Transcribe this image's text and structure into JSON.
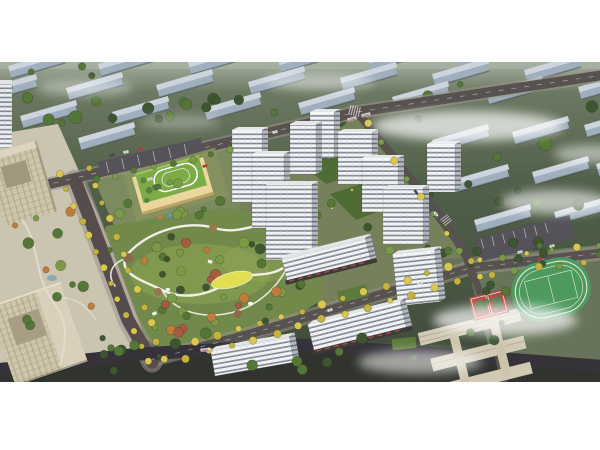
{
  "meta": {
    "subject": "aerial-masterplan-rendering",
    "framing": "white-letterbox"
  },
  "colors": {
    "page-bg": "#ffffff",
    "ground-top": "#75816a",
    "ground-mid": "#51604a",
    "ground-bottom": "#3e4a38",
    "haze": "#aab5a7",
    "fog": "#ffffff",
    "bg-building-top": "#ccd5de",
    "bg-building-face": "#9fafbd",
    "road": "#57524f",
    "road-dark": "#35323a",
    "sidewalk": "#9b938a",
    "boulevard": "#564c4e",
    "tower-face": "#f3f4f5",
    "tower-stripe": "#67707e",
    "tower-roof": "#e4e7ea",
    "office-face": "#cfc6ac",
    "office-line": "#9c9277",
    "park-base": "#71894a",
    "park-light": "#94aa57",
    "lawn-yellow": "#e0df52",
    "path-white": "#f1efe5",
    "tree-dark": "#3d5531",
    "tree-mid": "#547636",
    "tree-light": "#7a9a47",
    "tree-orange": "#c07c3c",
    "tree-red": "#a85a40",
    "tree-yellow": "#d9c750",
    "tree-yellow2": "#c4b23e",
    "kg-wall": "#ebd79e",
    "kg-roof": "#7cab48",
    "podium-green": "#5b7a3b",
    "courtyard-green": "#4e6c34",
    "field-green": "#4e9a5e",
    "court-red": "#b04a40",
    "track-white": "#e9e7de",
    "car-white": "#f2f2f2",
    "car-red": "#c24438",
    "car-dark": "#4a4f55",
    "parking-grey": "#55525a"
  },
  "scene": {
    "bg_blocks": [
      [
        8,
        4
      ],
      [
        98,
        2
      ],
      [
        188,
        0
      ],
      [
        278,
        -2
      ],
      [
        368,
        -4
      ],
      [
        458,
        -6
      ],
      [
        548,
        -8
      ],
      [
        -20,
        28
      ],
      [
        66,
        26
      ],
      [
        156,
        23
      ],
      [
        248,
        20
      ],
      [
        340,
        16
      ],
      [
        432,
        12
      ],
      [
        524,
        8
      ],
      [
        20,
        54
      ],
      [
        112,
        50
      ],
      [
        204,
        46
      ],
      [
        298,
        41
      ],
      [
        392,
        35
      ],
      [
        486,
        30
      ],
      [
        578,
        25
      ],
      [
        -10,
        80
      ],
      [
        78,
        76
      ],
      [
        432,
        78
      ],
      [
        512,
        70
      ],
      [
        584,
        63
      ],
      [
        452,
        118
      ],
      [
        532,
        110
      ],
      [
        596,
        102
      ],
      [
        474,
        158
      ],
      [
        554,
        150
      ]
    ],
    "buildings": [
      {
        "type": "tower",
        "x": 310,
        "base": 96,
        "w": 24,
        "h": 46
      },
      {
        "type": "tower",
        "x": 290,
        "base": 112,
        "w": 26,
        "h": 50
      },
      {
        "type": "tower",
        "x": 338,
        "base": 122,
        "w": 34,
        "h": 52
      },
      {
        "type": "tower",
        "x": 427,
        "base": 130,
        "w": 28,
        "h": 48
      },
      {
        "type": "tower",
        "x": 232,
        "base": 140,
        "w": 30,
        "h": 72
      },
      {
        "type": "tower",
        "x": 362,
        "base": 150,
        "w": 36,
        "h": 54
      },
      {
        "type": "tower",
        "x": 252,
        "base": 166,
        "w": 32,
        "h": 74
      },
      {
        "type": "tower",
        "x": 383,
        "base": 182,
        "w": 40,
        "h": 56
      },
      {
        "type": "tower",
        "x": 266,
        "base": 198,
        "w": 46,
        "h": 76
      },
      {
        "type": "slab",
        "x": 288,
        "base": 222,
        "w": 86,
        "h": 26,
        "rot": -14,
        "retail": true
      },
      {
        "type": "slab",
        "x": 398,
        "base": 244,
        "w": 42,
        "h": 52,
        "rot": -6
      },
      {
        "type": "slab",
        "x": 315,
        "base": 292,
        "w": 95,
        "h": 30,
        "rot": -14,
        "retail": true
      },
      {
        "type": "slab",
        "x": 215,
        "base": 314,
        "w": 80,
        "h": 26,
        "rot": -10
      }
    ],
    "avenues": [
      {
        "x1": 60,
        "y1": 112,
        "x2": 148,
        "y2": 300,
        "n": 13,
        "r": 3.2,
        "pal": [
          "tree-yellow",
          "tree-yellow2"
        ]
      },
      {
        "x1": 88,
        "y1": 106,
        "x2": 164,
        "y2": 296,
        "n": 12,
        "r": 3.0,
        "pal": [
          "tree-yellow2",
          "tree-yellow"
        ]
      },
      {
        "x1": 196,
        "y1": 280,
        "x2": 470,
        "y2": 200,
        "n": 14,
        "r": 3.4,
        "pal": [
          "tree-yellow",
          "tree-yellow2"
        ]
      },
      {
        "x1": 186,
        "y1": 296,
        "x2": 480,
        "y2": 214,
        "n": 14,
        "r": 3.2,
        "pal": [
          "tree-yellow2",
          "tree-yellow"
        ]
      },
      {
        "x1": 480,
        "y1": 198,
        "x2": 600,
        "y2": 183,
        "n": 6,
        "r": 3.0,
        "pal": [
          "tree-yellow",
          "tree-light"
        ]
      },
      {
        "x1": 492,
        "y1": 212,
        "x2": 606,
        "y2": 197,
        "n": 6,
        "r": 3.0,
        "pal": [
          "tree-yellow2",
          "tree-light"
        ]
      },
      {
        "x1": 96,
        "y1": 118,
        "x2": 230,
        "y2": 88,
        "n": 8,
        "r": 3.0,
        "pal": [
          "tree-mid",
          "tree-light"
        ]
      },
      {
        "x1": 368,
        "y1": 62,
        "x2": 460,
        "y2": 188,
        "n": 8,
        "r": 3.0,
        "pal": [
          "tree-yellow",
          "tree-light"
        ]
      }
    ],
    "scatter": [
      {
        "x": 0,
        "y": 0,
        "w": 92,
        "h": 66,
        "n": 10,
        "layer": "bg",
        "pal": [
          "tree-dark",
          "tree-mid"
        ],
        "rmin": 3,
        "rmax": 7
      },
      {
        "x": 96,
        "y": 30,
        "w": 210,
        "h": 34,
        "n": 12,
        "layer": "bg",
        "pal": [
          "tree-dark",
          "tree-mid"
        ],
        "rmin": 3,
        "rmax": 6
      },
      {
        "x": 360,
        "y": 6,
        "w": 238,
        "h": 150,
        "n": 16,
        "layer": "bg",
        "pal": [
          "tree-dark",
          "tree-mid"
        ],
        "rmin": 3,
        "rmax": 7
      },
      {
        "x": 300,
        "y": 58,
        "w": 60,
        "h": 30,
        "n": 5,
        "layer": "bg",
        "pal": [
          "tree-dark"
        ],
        "rmin": 3,
        "rmax": 5
      },
      {
        "x": 15,
        "y": 148,
        "w": 96,
        "h": 128,
        "n": 14,
        "layer": "mid",
        "pal": [
          "tree-mid",
          "tree-orange",
          "tree-light"
        ],
        "rmin": 2.6,
        "rmax": 5.5
      },
      {
        "x": 118,
        "y": 116,
        "w": 118,
        "h": 42,
        "n": 12,
        "layer": "mid",
        "pal": [
          "tree-mid",
          "tree-light"
        ],
        "rmin": 2.6,
        "rmax": 5
      },
      {
        "x": 250,
        "y": 84,
        "w": 150,
        "h": 112,
        "n": 14,
        "layer": "mid",
        "pal": [
          "tree-mid",
          "tree-light",
          "tree-dark"
        ],
        "rmin": 2.4,
        "rmax": 4.6
      },
      {
        "x": 420,
        "y": 176,
        "w": 180,
        "h": 26,
        "n": 12,
        "layer": "mid",
        "pal": [
          "tree-mid",
          "tree-dark"
        ],
        "rmin": 2.6,
        "rmax": 5
      },
      {
        "x": 468,
        "y": 210,
        "w": 40,
        "h": 100,
        "n": 8,
        "layer": "mid",
        "pal": [
          "tree-dark",
          "tree-mid"
        ],
        "rmin": 2.6,
        "rmax": 5
      },
      {
        "x": 60,
        "y": 276,
        "w": 400,
        "h": 36,
        "n": 16,
        "layer": "top",
        "pal": [
          "tree-dark",
          "tree-mid"
        ],
        "rmin": 2.6,
        "rmax": 5.5
      }
    ],
    "park": {
      "cx": 214,
      "cy": 222,
      "rx": 100,
      "ry": 54,
      "under": 30,
      "over": 12,
      "pal": [
        "tree-dark",
        "tree-mid",
        "tree-light",
        "tree-orange",
        "tree-red",
        "tree-light"
      ]
    },
    "fog": [
      [
        468,
        64,
        95,
        15,
        0.7
      ],
      [
        320,
        20,
        55,
        8,
        0.45
      ],
      [
        85,
        26,
        48,
        8,
        0.4
      ],
      [
        556,
        140,
        55,
        12,
        0.6
      ],
      [
        505,
        258,
        72,
        15,
        0.7
      ],
      [
        420,
        300,
        62,
        12,
        0.55
      ],
      [
        592,
        92,
        38,
        9,
        0.5
      ],
      [
        180,
        60,
        40,
        7,
        0.3
      ]
    ],
    "cars": [
      {
        "x": 150,
        "y": 117,
        "r": -13,
        "c": "car-white"
      },
      {
        "x": 205,
        "y": 104,
        "r": -13,
        "c": "car-red"
      },
      {
        "x": 275,
        "y": 70,
        "r": -13,
        "c": "car-white"
      },
      {
        "x": 352,
        "y": 57,
        "r": -14,
        "c": "car-white",
        "bus": true
      },
      {
        "x": 366,
        "y": 53,
        "r": -14,
        "c": "car-white",
        "bus": true
      },
      {
        "x": 416,
        "y": 130,
        "r": 52,
        "c": "car-dark"
      },
      {
        "x": 436,
        "y": 152,
        "r": 52,
        "c": "car-white"
      },
      {
        "x": 330,
        "y": 248,
        "r": -17,
        "c": "car-white"
      },
      {
        "x": 420,
        "y": 221,
        "r": -17,
        "c": "car-white"
      },
      {
        "x": 540,
        "y": 197,
        "r": -7,
        "c": "car-red"
      },
      {
        "x": 205,
        "y": 288,
        "r": -3,
        "c": "car-white",
        "bus": true
      },
      {
        "x": 112,
        "y": 93,
        "r": -13,
        "c": "car-dark"
      },
      {
        "x": 126,
        "y": 90,
        "r": -13,
        "c": "car-white"
      },
      {
        "x": 140,
        "y": 87,
        "r": -13,
        "c": "car-red"
      },
      {
        "x": 520,
        "y": 190,
        "r": -14,
        "c": "car-white"
      },
      {
        "x": 536,
        "y": 187,
        "r": -14,
        "c": "car-dark"
      },
      {
        "x": 552,
        "y": 184,
        "r": -14,
        "c": "car-white"
      }
    ]
  }
}
